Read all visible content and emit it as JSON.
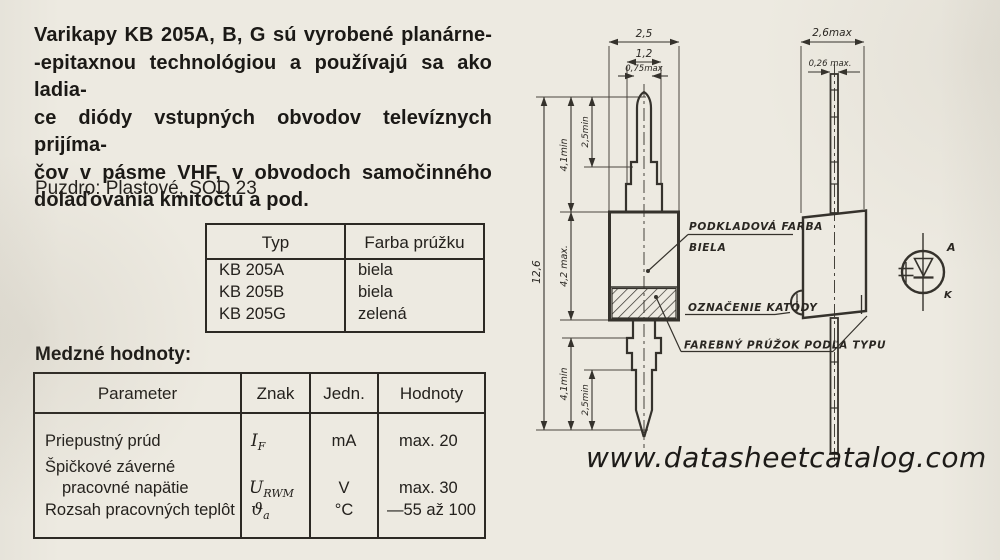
{
  "colors": {
    "paper": "#edeae1",
    "ink": "#1b1916",
    "line": "#35322c"
  },
  "intro": {
    "lines": [
      "Varikapy KB 205A, B, G sú vyrobené planárne-",
      "-epitaxnou technológiou a používajú sa ako ladia-",
      "ce diódy vstupných obvodov televíznych prijíma-",
      "čov v pásme VHF, v obvodoch samočinného",
      "dolaďovania kmitočtu a pod."
    ]
  },
  "package_line": "Puzdro: Plastové, SOD 23",
  "type_table": {
    "headers": [
      "Typ",
      "Farba prúžku"
    ],
    "rows": [
      {
        "typ": "KB 205A",
        "farba": "biela"
      },
      {
        "typ": "KB 205B",
        "farba": "biela"
      },
      {
        "typ": "KB 205G",
        "farba": "zelená"
      }
    ]
  },
  "limits": {
    "heading": "Medzné hodnoty:",
    "headers": [
      "Parameter",
      "Znak",
      "Jedn.",
      "Hodnoty"
    ],
    "rows": [
      {
        "parameter": "Priepustný prúd",
        "symbol": "I",
        "sub": "F",
        "unit": "mA",
        "value": "max. 20"
      },
      {
        "parameter_line1": "Špičkové záverné",
        "parameter_line2": "pracovné napätie",
        "symbol": "U",
        "sub": "RWM",
        "unit": "V",
        "value": "max. 30"
      },
      {
        "parameter": "Rozsah pracovných teplôt",
        "symbol": "ϑ",
        "sub": "a",
        "unit": "°C",
        "value": "—55 až 100"
      }
    ]
  },
  "drawing": {
    "front": {
      "dim_width_outer": "2,5",
      "dim_width_mid": "1,2",
      "dim_width_lead": "0,75max",
      "dim_total": "12,6",
      "dim_lead_top": "4,1min",
      "dim_tip_top": "2,5min",
      "dim_body": "4,2 max.",
      "dim_lead_bottom": "4,1min",
      "dim_tip_bottom": "2,5min"
    },
    "side": {
      "dim_width": "2,6max",
      "dim_lead": "0,26 max."
    },
    "callouts": {
      "base_color_line1": "PODKLADOVÁ FARBA",
      "base_color_line2": "BIELA",
      "cathode_mark": "OZNAČENIE KATÓDY",
      "color_stripe": "FAREBNÝ PRÚŽOK PODĽA TYPU"
    },
    "symbol_labels": {
      "anode": "A",
      "cathode": "K"
    }
  },
  "watermark": "www.datasheetcatalog.com"
}
